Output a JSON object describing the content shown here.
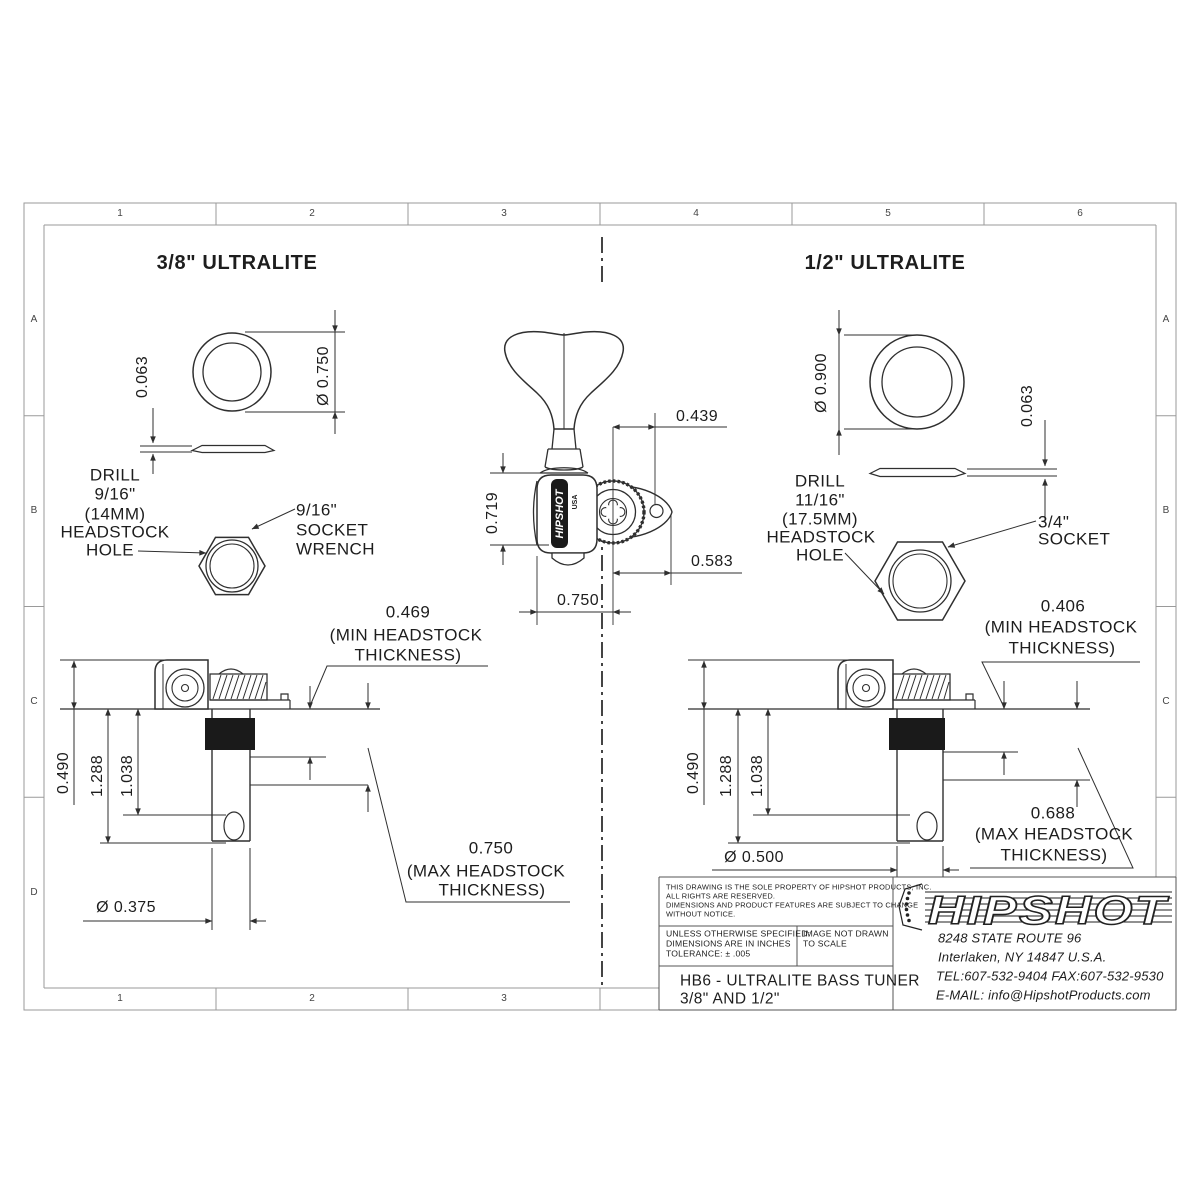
{
  "sheet": {
    "cols": [
      "1",
      "2",
      "3",
      "4",
      "5",
      "6"
    ],
    "cols_bottom": [
      "1",
      "2",
      "3"
    ],
    "rows_left": [
      "A",
      "B",
      "C",
      "D"
    ],
    "rows_right": [
      "A",
      "B",
      "C"
    ],
    "line_color": "#2f2f2f",
    "border_color": "#9a9a9a"
  },
  "left": {
    "title": "3/8\" ULTRALITE",
    "washer_od": "Ø 0.750",
    "washer_thk": "0.063",
    "drill": [
      "DRILL",
      "9/16\"",
      "(14MM)",
      "HEADSTOCK",
      "HOLE"
    ],
    "socket": [
      "9/16\"",
      "SOCKET",
      "WRENCH"
    ],
    "min_thk": [
      "0.469",
      "(MIN HEADSTOCK",
      "THICKNESS)"
    ],
    "max_thk": [
      "0.750",
      "(MAX HEADSTOCK",
      "THICKNESS)"
    ],
    "height": "0.490",
    "length": "1.288",
    "to_hole": "1.038",
    "post_od": "Ø 0.375"
  },
  "center": {
    "key_offset": "0.439",
    "body_height": "0.719",
    "ear_offset": "0.583",
    "width": "0.750",
    "brand": "HIPSHOT",
    "brand_sub": "USA"
  },
  "right": {
    "title": "1/2\" ULTRALITE",
    "washer_od": "Ø 0.900",
    "washer_thk": "0.063",
    "drill": [
      "DRILL",
      "11/16\"",
      "(17.5MM)",
      "HEADSTOCK",
      "HOLE"
    ],
    "socket": [
      "3/4\"",
      "SOCKET"
    ],
    "min_thk": [
      "0.406",
      "(MIN HEADSTOCK",
      "THICKNESS)"
    ],
    "max_thk": [
      "0.688",
      "(MAX HEADSTOCK",
      "THICKNESS)"
    ],
    "height": "0.490",
    "length": "1.288",
    "to_hole": "1.038",
    "post_od": "Ø 0.500"
  },
  "title_block": {
    "property_note": [
      "THIS DRAWING IS THE SOLE PROPERTY OF HIPSHOT PRODUCTS, INC.",
      "ALL RIGHTS ARE RESERVED.",
      "DIMENSIONS AND PRODUCT FEATURES ARE SUBJECT TO CHANGE",
      "WITHOUT NOTICE."
    ],
    "spec_note": [
      "UNLESS OTHERWISE SPECIFIED:",
      "DIMENSIONS ARE IN INCHES",
      "TOLERANCE: ± .005"
    ],
    "scale_note": [
      "IMAGE NOT DRAWN",
      "TO SCALE"
    ],
    "part_title": [
      "HB6 - ULTRALITE BASS TUNER",
      "3/8\" AND 1/2\""
    ],
    "logo_text": "HIPSHOT",
    "address": [
      "8248 STATE ROUTE 96",
      "Interlaken, NY 14847 U.S.A.",
      "TEL:607-532-9404 FAX:607-532-9530",
      "E-MAIL: info@HipshotProducts.com"
    ]
  }
}
